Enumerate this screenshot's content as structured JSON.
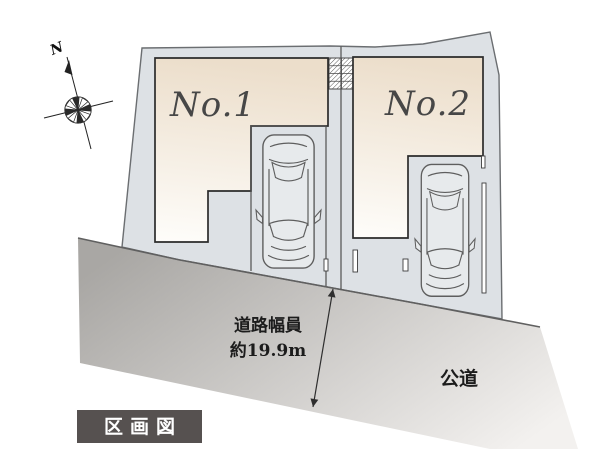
{
  "legend": {
    "label": "区画図"
  },
  "lots": {
    "lot1": {
      "label": "No.1"
    },
    "lot2": {
      "label": "No.2"
    }
  },
  "road": {
    "name": "公道",
    "width_caption_line1": "道路幅員",
    "width_caption_line2": "約19.9m"
  },
  "compass": {
    "north": "N"
  },
  "colors": {
    "background": "#ffffff",
    "site_fill": "#dde1e5",
    "site_outline": "#6b6e71",
    "building_fill_top": "#ecdecb",
    "building_fill_bottom": "#fefdfa",
    "building_outline": "#2b2b2b",
    "road_fill_dark": "#a9a7a4",
    "road_fill_light": "#f3f1ef",
    "road_edge": "#606060",
    "car_fill": "#e7eaec",
    "car_line": "#5e5e5e",
    "annotation_text": "#1c1c1c",
    "lot_label_text": "#474747",
    "badge_background": "#565150",
    "badge_text": "#ffffff",
    "hatch_line": "#4a4a4a"
  }
}
